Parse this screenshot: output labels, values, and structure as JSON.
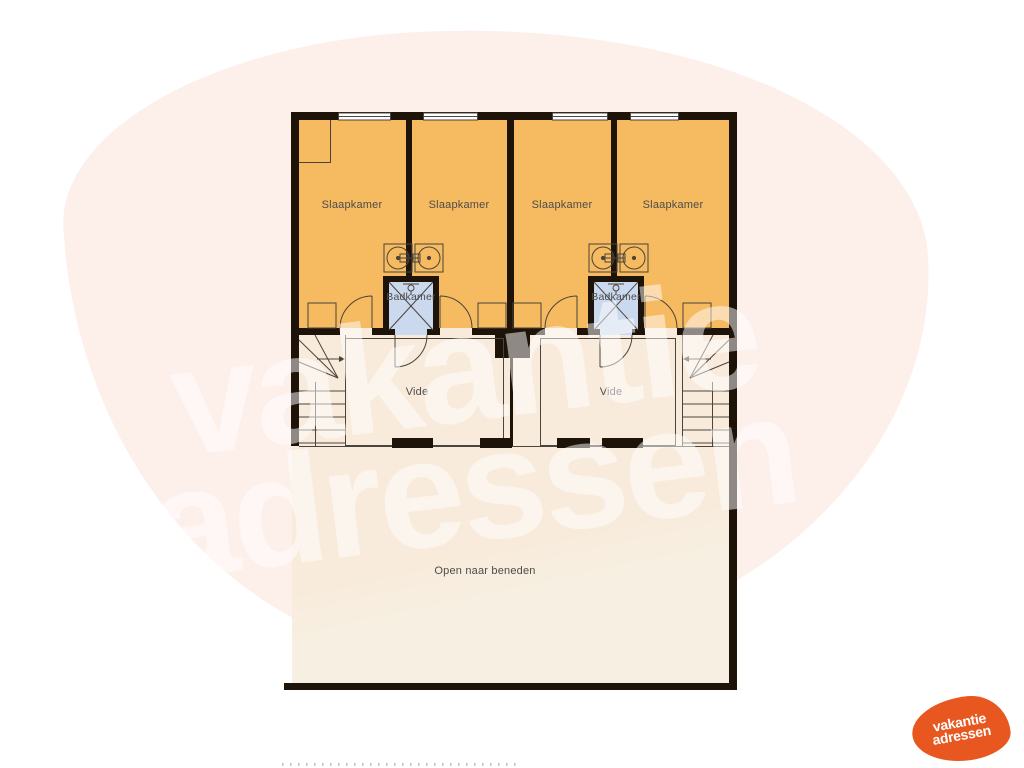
{
  "watermark": {
    "line1": "vakantie",
    "line2": "adressen",
    "blob_color": "#fdf0eb",
    "text_color": "#ffffff"
  },
  "logo": {
    "line1": "vakantie",
    "line2": "adressen",
    "blob_color": "#e8571f",
    "text_color": "#ffffff"
  },
  "floorplan": {
    "wall_color": "#1d1309",
    "bedroom_color": "#f6ba60",
    "bathroom_color": "#cbd9ee",
    "hall_color": "#f8ebdc",
    "open_area_color": "#f7f0e2",
    "bedrooms": [
      {
        "label": "Slaapkamer"
      },
      {
        "label": "Slaapkamer"
      },
      {
        "label": "Slaapkamer"
      },
      {
        "label": "Slaapkamer"
      }
    ],
    "bathrooms": [
      {
        "label": "Badkamer"
      },
      {
        "label": "Badkamer"
      }
    ],
    "vides": [
      {
        "label": "Vide"
      },
      {
        "label": "Vide"
      }
    ],
    "open_area_label": "Open naar beneden"
  }
}
